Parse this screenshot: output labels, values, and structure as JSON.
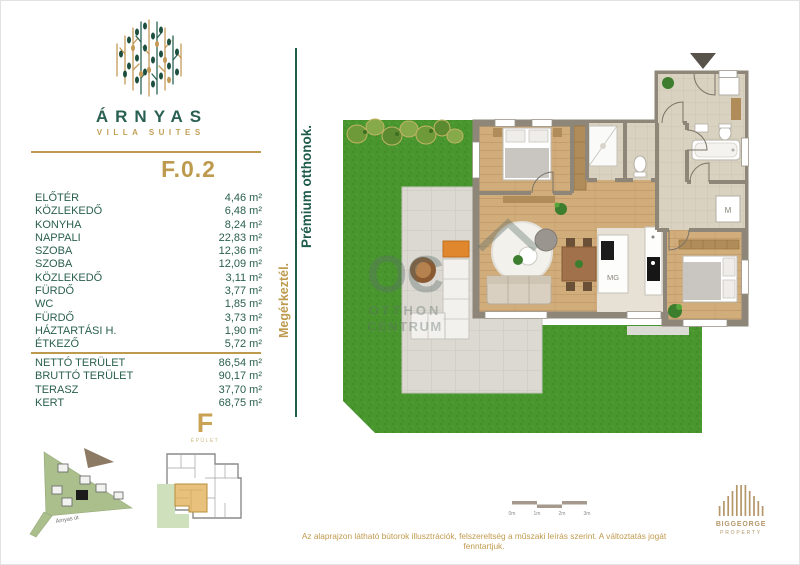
{
  "brand": {
    "name": "ÁRNYAS",
    "subtitle": "VILLA SUITES"
  },
  "unit": {
    "code": "F.0.2",
    "building_letter": "F",
    "building_caption": "ÉPÜLET"
  },
  "room_list": [
    {
      "label": "ELŐTÉR",
      "value": "4,46 m²"
    },
    {
      "label": "KÖZLEKEDŐ",
      "value": "6,48 m²"
    },
    {
      "label": "KONYHA",
      "value": "8,24 m²"
    },
    {
      "label": "NAPPALI",
      "value": "22,83 m²"
    },
    {
      "label": "SZOBA",
      "value": "12,36 m²"
    },
    {
      "label": "SZOBA",
      "value": "12,09 m²"
    },
    {
      "label": "KÖZLEKEDŐ",
      "value": "3,11 m²"
    },
    {
      "label": "FÜRDŐ",
      "value": "3,77 m²"
    },
    {
      "label": "WC",
      "value": "1,85 m²"
    },
    {
      "label": "FÜRDŐ",
      "value": "3,73 m²"
    },
    {
      "label": "HÁZTARTÁSI H.",
      "value": "1,90 m²"
    },
    {
      "label": "ÉTKEZŐ",
      "value": "5,72 m²"
    }
  ],
  "totals": [
    {
      "label": "NETTÓ TERÜLET",
      "value": "86,54 m²"
    },
    {
      "label": "BRUTTÓ TERÜLET",
      "value": "90,17 m²"
    },
    {
      "label": "TERASZ",
      "value": "37,70 m²"
    },
    {
      "label": "KERT",
      "value": "68,75 m²"
    }
  ],
  "taglines": {
    "primary": "Megérkeztél.",
    "secondary": "Prémium otthonok."
  },
  "floor_plan": {
    "appliance_labels": {
      "kitchen_island": "MG",
      "washing_machine": "M"
    },
    "watermark": {
      "monogram": "OC",
      "line1": "OTTHON",
      "line2": "CENTRUM"
    }
  },
  "site_plan": {
    "street_label": "Árnyas út"
  },
  "scale_bar": {
    "labels": [
      "0m",
      "1m",
      "2m",
      "3m"
    ]
  },
  "footer": {
    "disclaimer": "Az alaprajzon látható bútorok illusztrációk, felszereltség a műszaki leírás szerint. A változtatás jogát fenntartjuk.",
    "logo_line1": "BIGGEORGE",
    "logo_line2": "PROPERTY"
  },
  "colors": {
    "gold": "#bd9a4d",
    "teal": "#2a5f4f",
    "grass": "#49962e",
    "terrace": "#dcd9d3",
    "wood": "#d2ad7c",
    "wall": "#8e8779"
  }
}
